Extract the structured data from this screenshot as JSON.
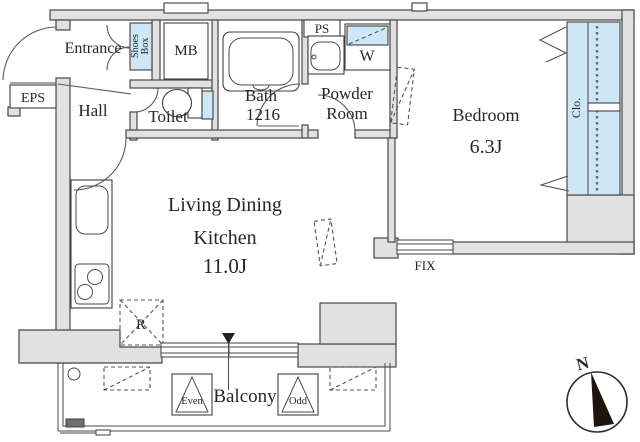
{
  "floorplan": {
    "rooms": {
      "entrance": "Entrance",
      "hall": "Hall",
      "toilet": "Toilet",
      "bath_line1": "Bath",
      "bath_line2": "1216",
      "powder_line1": "Powder",
      "powder_line2": "Room",
      "bedroom_name": "Bedroom",
      "bedroom_size": "6.3J",
      "ldk_line1": "Living Dining",
      "ldk_line2": "Kitchen",
      "ldk_size": "11.0J",
      "balcony": "Balcony",
      "closet": "Clo."
    },
    "labels": {
      "eps": "EPS",
      "mb": "MB",
      "ps": "PS",
      "washer": "W",
      "shoes_line1": "Shoes",
      "shoes_line2": "Box",
      "refrigerator": "R",
      "fix_window": "FIX",
      "hatch_even": "Even",
      "hatch_odd": "Odd",
      "compass_north": "N"
    },
    "colors": {
      "wall_fill": "#e1e1e1",
      "fixture_blue": "#cde7f6",
      "line": "#474747",
      "text": "#262626"
    }
  }
}
